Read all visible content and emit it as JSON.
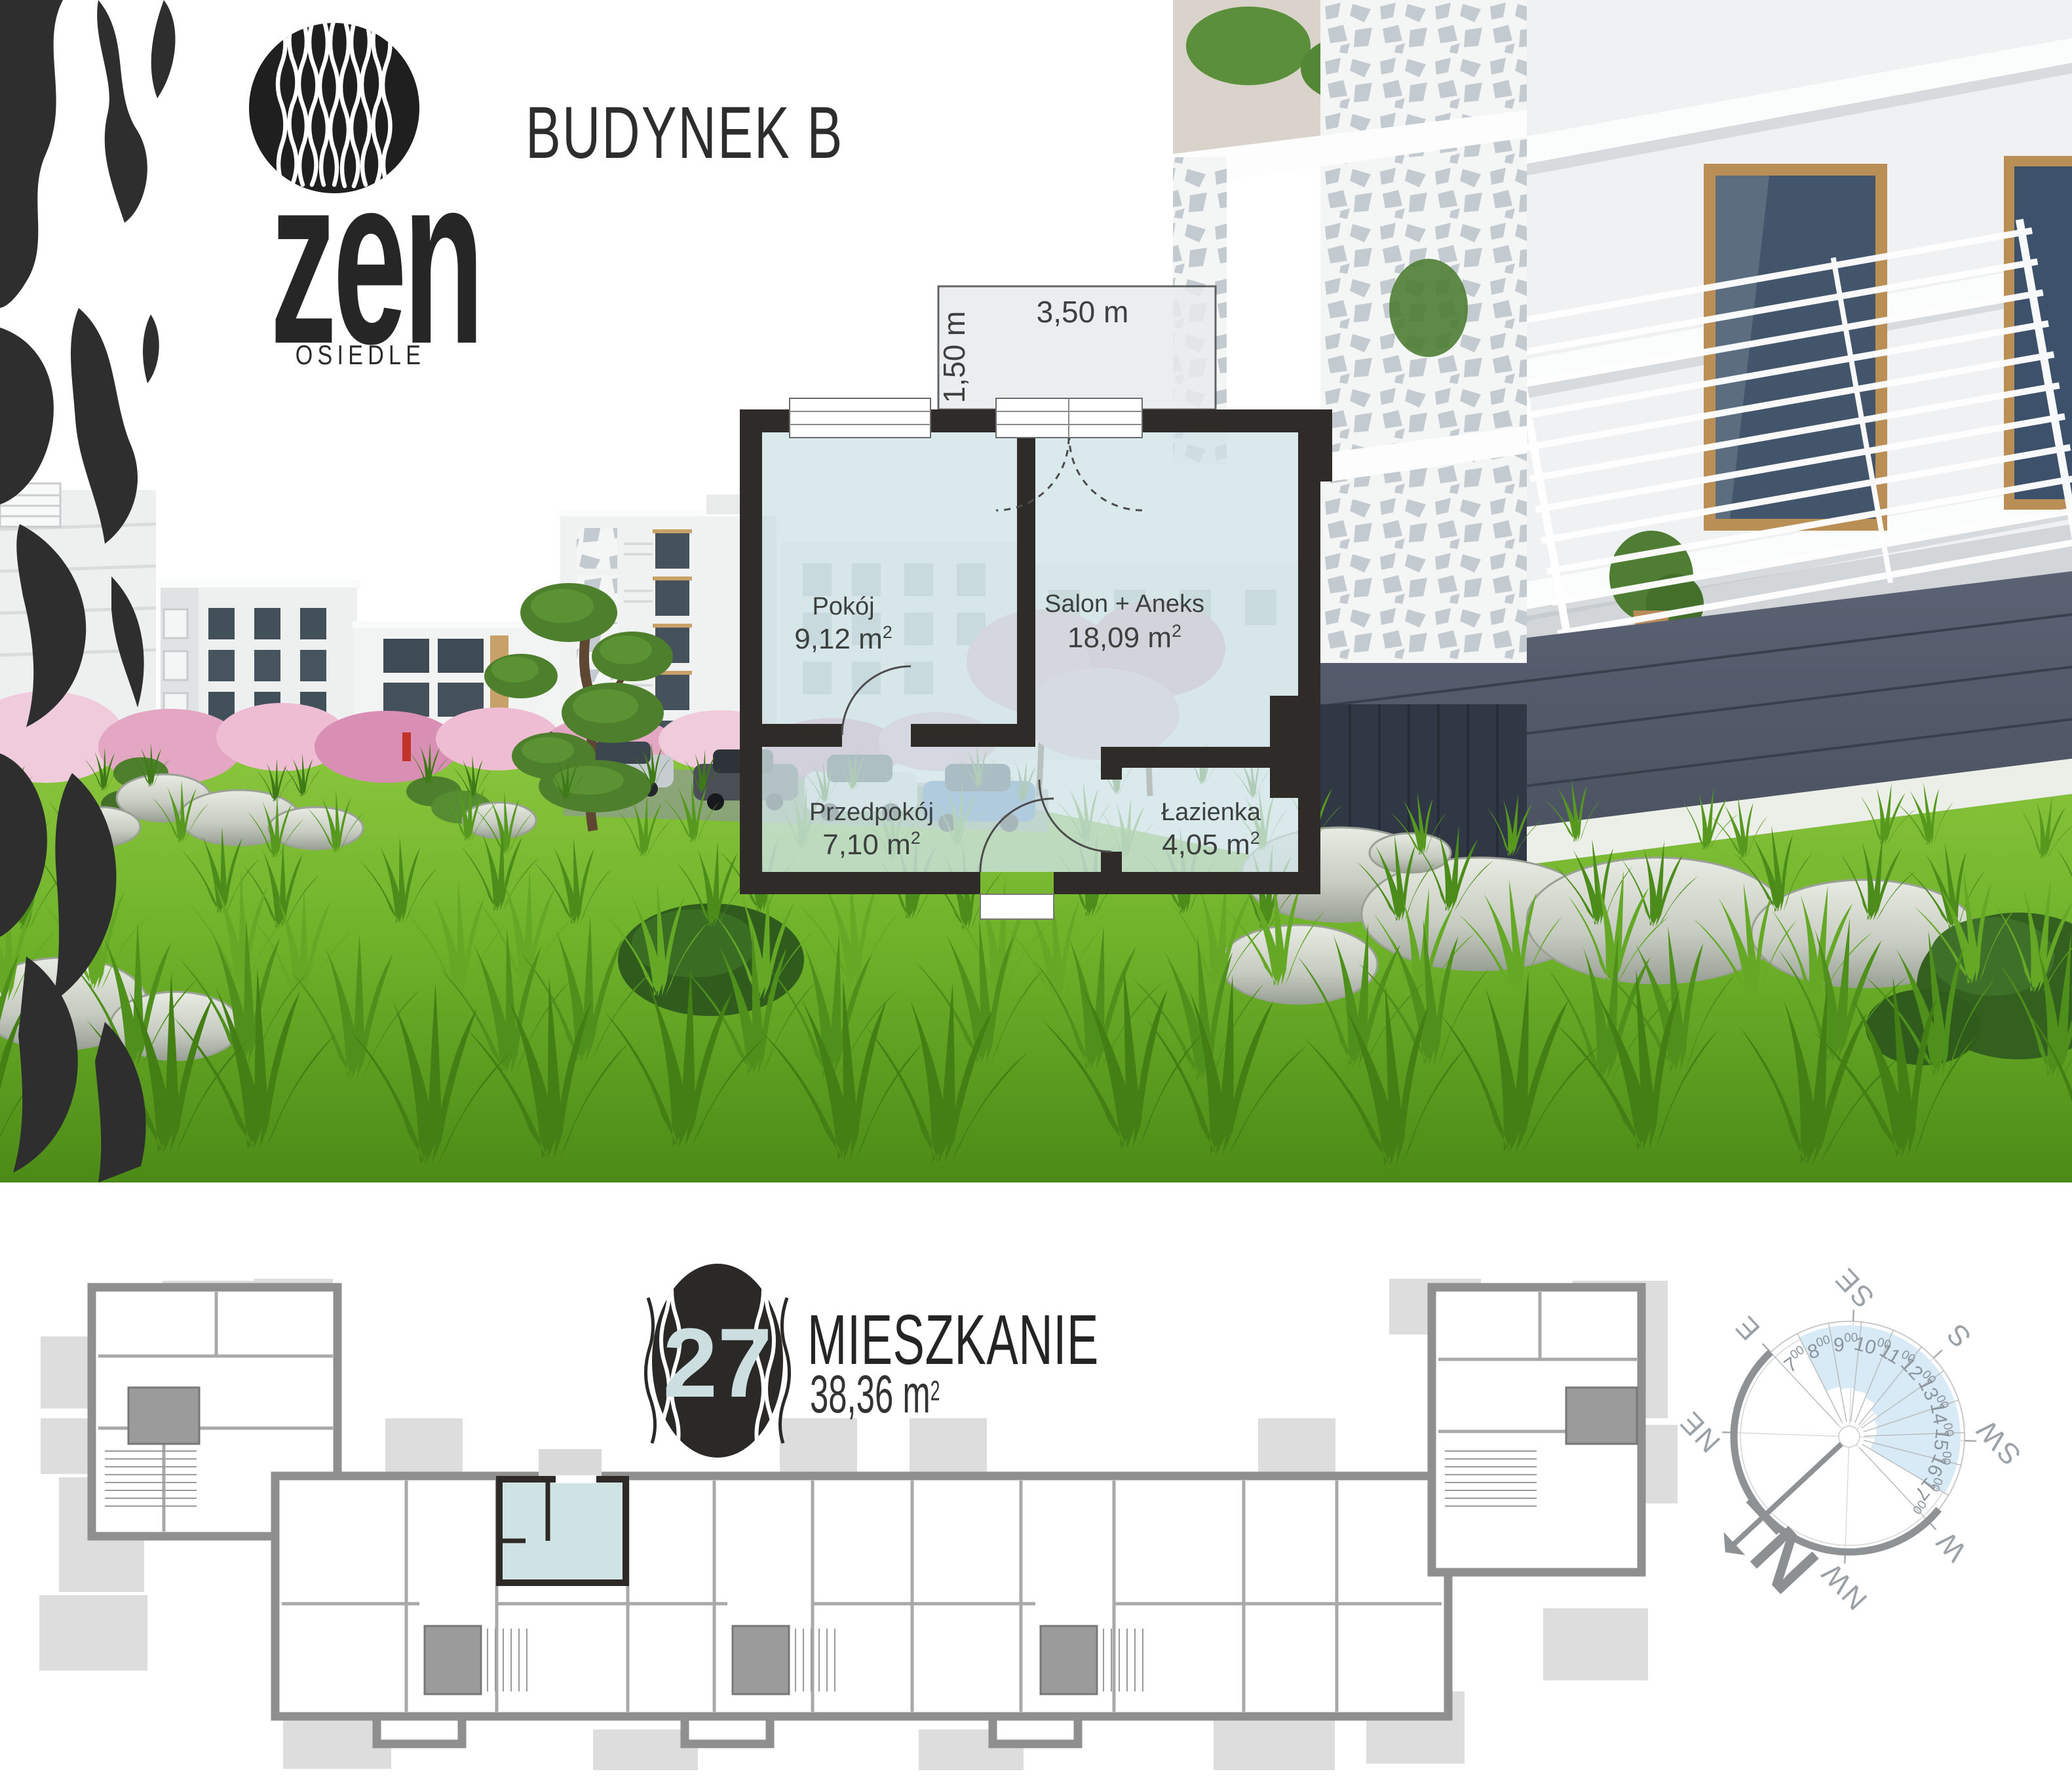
{
  "brand": {
    "logo_text": "zen",
    "logo_subtitle": "OSIEDLE"
  },
  "header": {
    "building_label": "BUDYNEK B"
  },
  "floorplan": {
    "balcony": {
      "width_label": "3,50 m",
      "depth_label": "1,50 m"
    },
    "rooms": [
      {
        "name": "Pokój",
        "area_value": "9,12 m",
        "area_sup": "2"
      },
      {
        "name": "Salon + Aneks",
        "area_value": "18,09 m",
        "area_sup": "2"
      },
      {
        "name": "Przedpokój",
        "area_value": "7,10 m",
        "area_sup": "2"
      },
      {
        "name": "Łazienka",
        "area_value": "4,05 m",
        "area_sup": "2"
      }
    ]
  },
  "unit": {
    "number": "27",
    "label": "MIESZKANIE",
    "area_value": "38,36 m",
    "area_sup": "2"
  },
  "compass": {
    "rotation_deg": 227,
    "directions": [
      "N",
      "NE",
      "E",
      "SE",
      "S",
      "SW",
      "W",
      "NW"
    ],
    "hours": [
      {
        "label": "7",
        "sup": "00",
        "sun": false
      },
      {
        "label": "8",
        "sup": "00",
        "sun": true
      },
      {
        "label": "9",
        "sup": "00",
        "sun": true
      },
      {
        "label": "10",
        "sup": "00",
        "sun": true
      },
      {
        "label": "11",
        "sup": "00",
        "sun": true
      },
      {
        "label": "12",
        "sup": "00",
        "sun": true
      },
      {
        "label": "13",
        "sup": "00",
        "sun": true
      },
      {
        "label": "14",
        "sup": "00",
        "sun": true
      },
      {
        "label": "15",
        "sup": "00",
        "sun": true
      },
      {
        "label": "16",
        "sup": "00",
        "sun": true
      },
      {
        "label": "17",
        "sup": "00",
        "sun": false
      }
    ],
    "sun_color": "#d8eaf6"
  },
  "colors": {
    "highlight_unit": "#cfe3e5",
    "plan_wall_dark": "#2e2b29",
    "plan_wall_gray": "#8f8f8f",
    "badge_dark": "#2b2927",
    "grass_green": "#6fb32a",
    "blossom_pink": "#e3a6c3"
  }
}
